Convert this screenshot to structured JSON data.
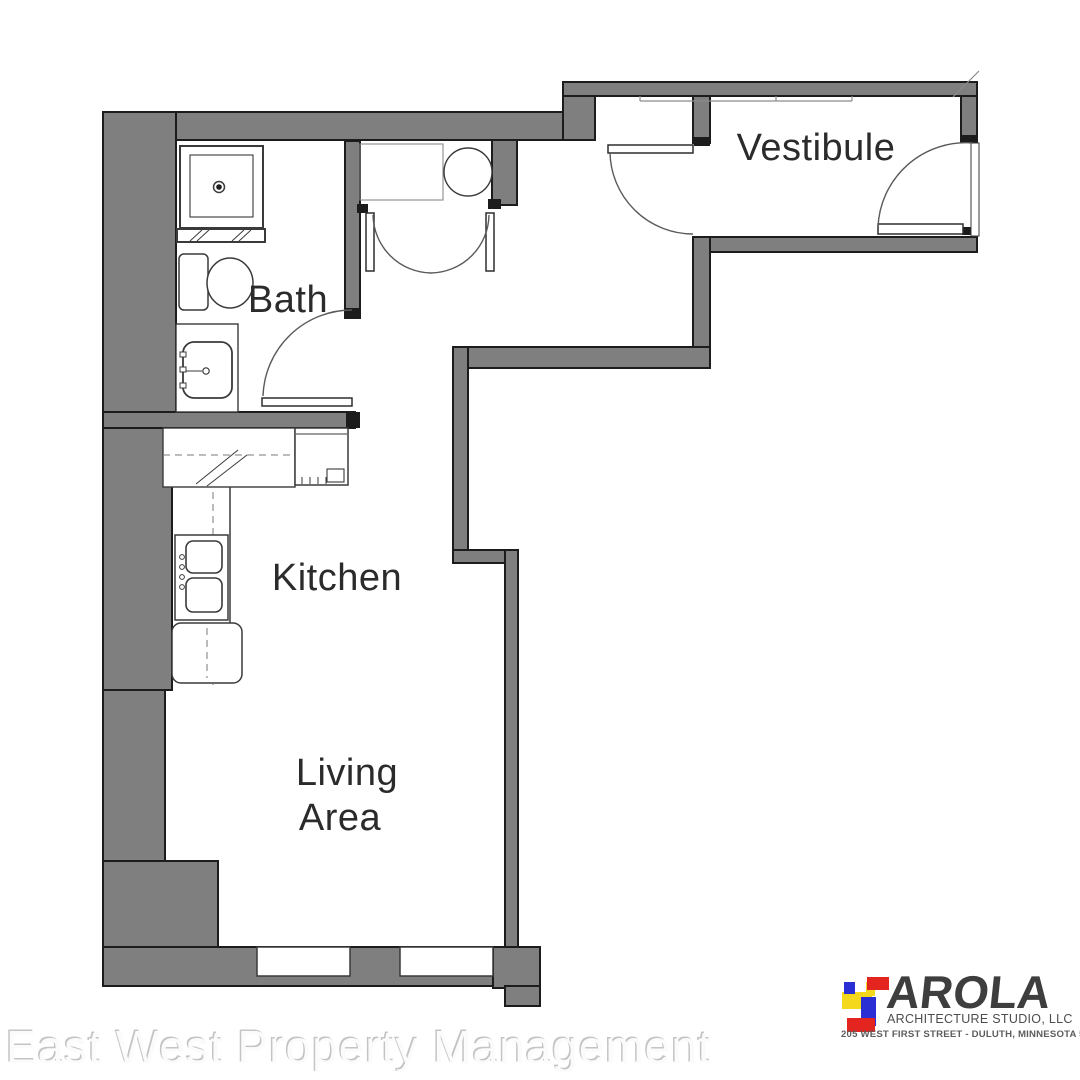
{
  "plan": {
    "rooms": {
      "bath": {
        "label": "Bath"
      },
      "kitchen": {
        "label": "Kitchen"
      },
      "living_area": {
        "label_line1": "Living",
        "label_line2": "Area"
      },
      "vestibule": {
        "label": "Vestibule"
      }
    },
    "colors": {
      "wall_fill": "#7f7f7f",
      "wall_edge": "#1c1c1c",
      "fixture_line": "#3a3a3a",
      "label_text": "#2b2b2b"
    }
  },
  "watermark": {
    "text": "East West Property Management"
  },
  "logo": {
    "name": "AROLA",
    "subtitle": "ARCHITECTURE STUDIO, LLC",
    "address": "205 WEST FIRST STREET - DULUTH, MINNESOTA 55802",
    "colors": {
      "red": "#e4251f",
      "blue": "#2a2fd4",
      "yellow": "#f4d81c",
      "text": "#3e3e3e"
    }
  }
}
